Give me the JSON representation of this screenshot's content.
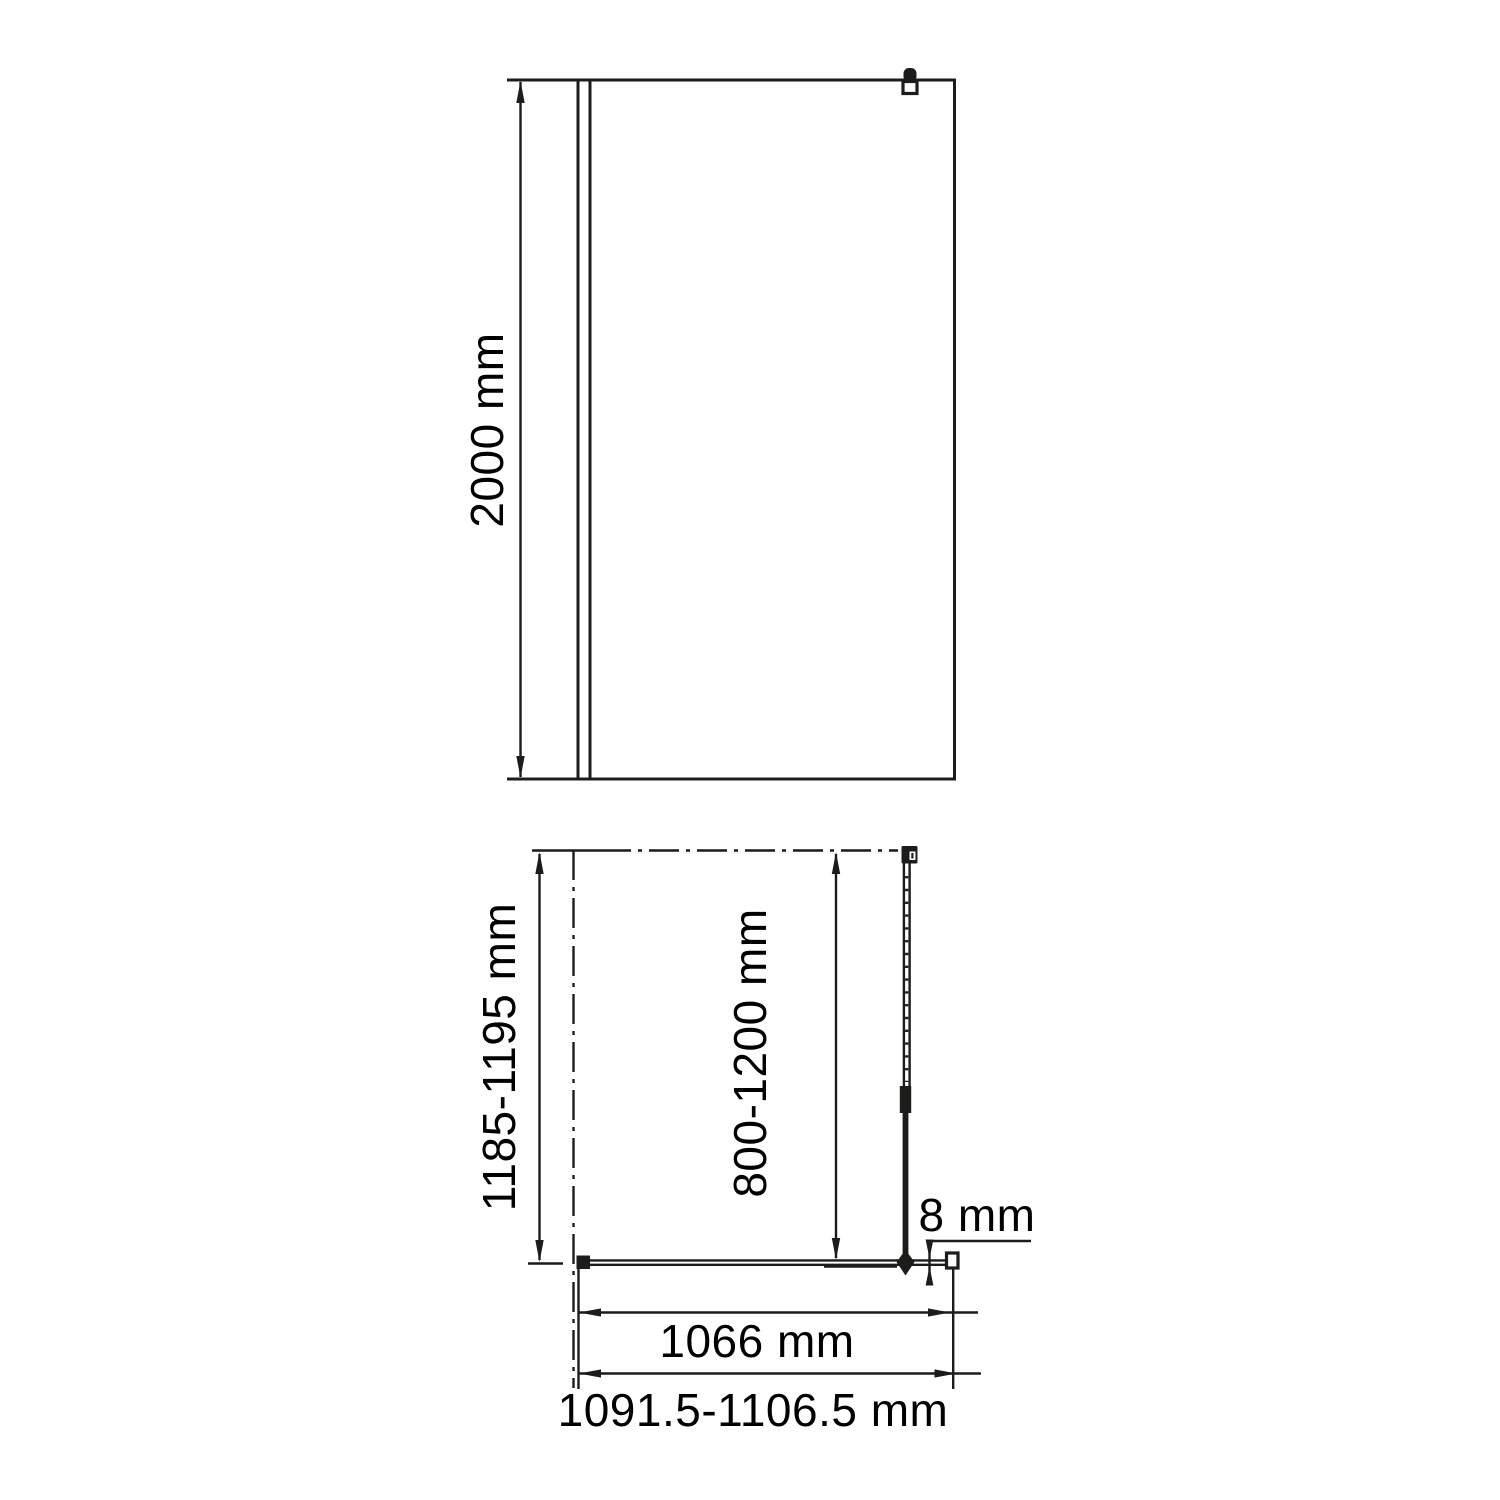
{
  "drawing_type": "shower-screen-technical-drawing",
  "colors": {
    "line": "#1c1c1a",
    "background": "#ffffff"
  },
  "front_view": {
    "height_label": "2000 mm"
  },
  "plan_view": {
    "depth_label": "1185-1195 mm",
    "support_bar_label": "800-1200 mm",
    "glass_thickness_label": "8 mm",
    "glass_width_label": "1066 mm",
    "install_width_label": "1091.5-1106.5 mm"
  },
  "symbols": {
    "wall_bracket": "wall-mount-bracket",
    "bar_connector": "support-bar-wall-connector",
    "support_bar": "telescopic-support-bar",
    "wall_profile": "wall-profile",
    "end_profile": "glass-end-profile"
  }
}
